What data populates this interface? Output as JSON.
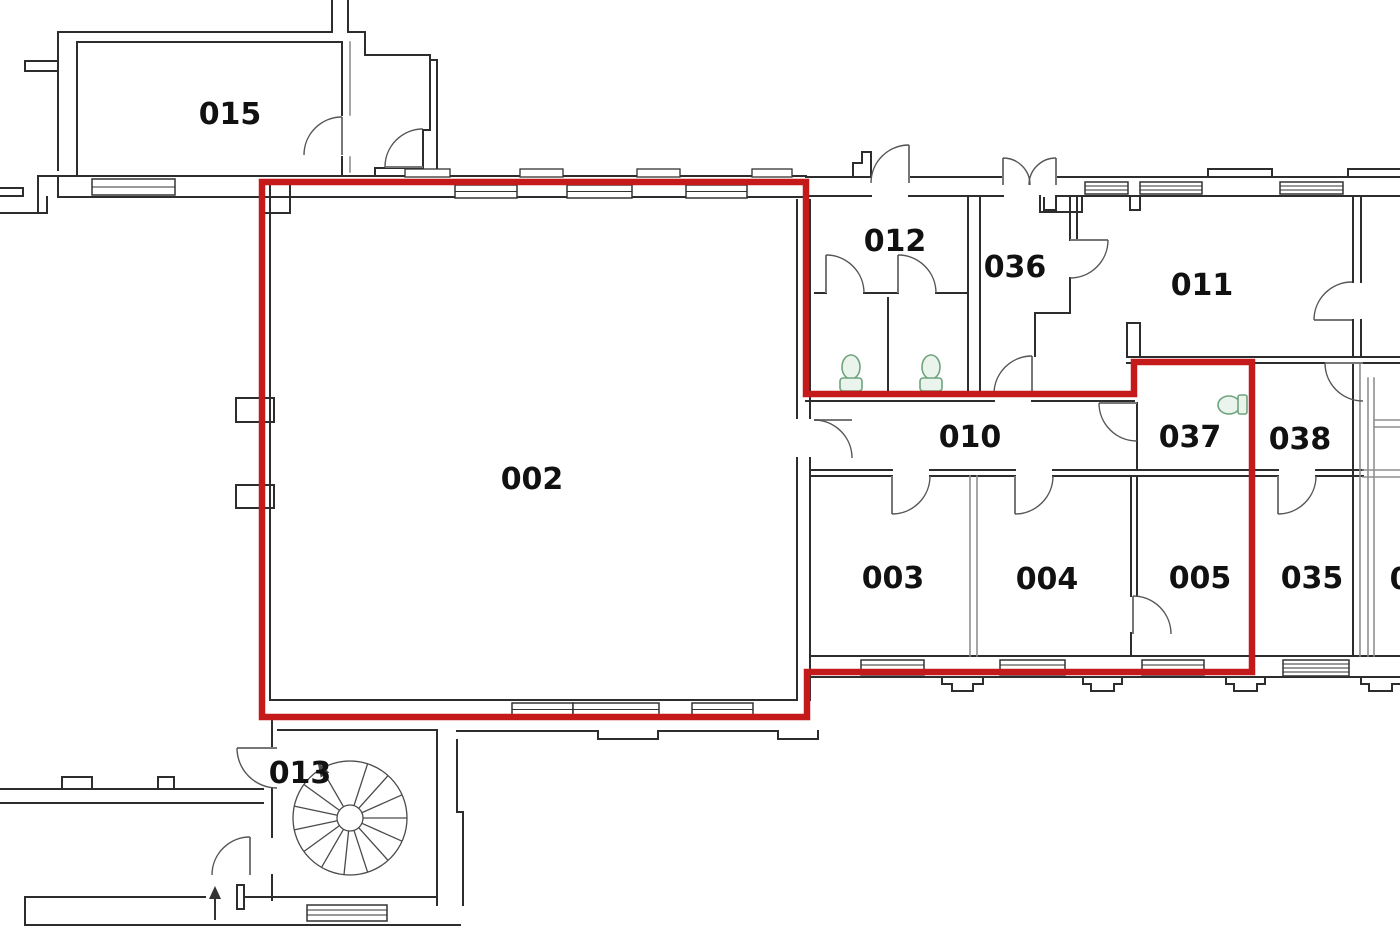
{
  "plan": {
    "kind": "floor-plan",
    "background": "#ffffff"
  },
  "colors": {
    "walls": "#2d2d2d",
    "walls_light": "#8f8f8f",
    "doors": "#555555",
    "fixtures": "#6fa37e",
    "labels": "#111111",
    "background": "#ffffff"
  },
  "highlight": {
    "color": "#c41a1a",
    "stroke_width": 6.5,
    "enclosed_room_ids": [
      "002",
      "010",
      "003",
      "004",
      "005",
      "037"
    ]
  },
  "rooms": [
    {
      "id": "015",
      "label": "015"
    },
    {
      "id": "002",
      "label": "002"
    },
    {
      "id": "012",
      "label": "012"
    },
    {
      "id": "036",
      "label": "036"
    },
    {
      "id": "011",
      "label": "011"
    },
    {
      "id": "010",
      "label": "010"
    },
    {
      "id": "037",
      "label": "037"
    },
    {
      "id": "038",
      "label": "038"
    },
    {
      "id": "003",
      "label": "003"
    },
    {
      "id": "004",
      "label": "004"
    },
    {
      "id": "005",
      "label": "005"
    },
    {
      "id": "035",
      "label": "035"
    },
    {
      "id": "013",
      "label": "013"
    },
    {
      "id": "0-partial",
      "label": "0"
    }
  ],
  "fixtures": {
    "toilet_count": 3,
    "spiral_staircase_count": 1,
    "entrance_arrow_count": 1
  }
}
